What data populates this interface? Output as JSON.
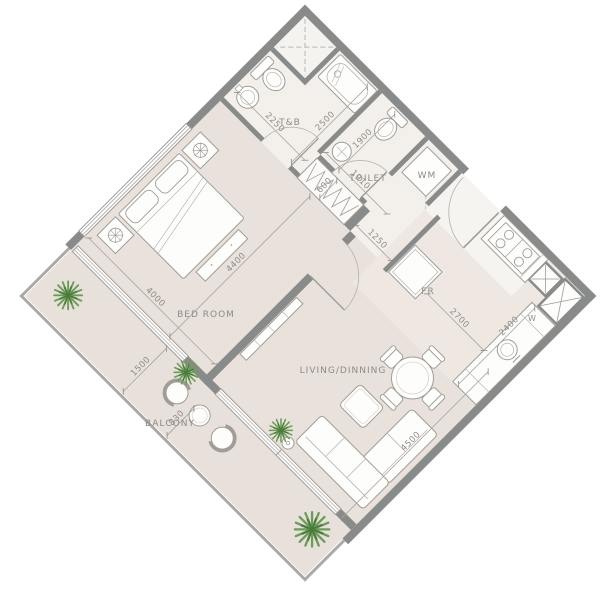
{
  "floor_plan": {
    "rooms": {
      "tnb": "T&B",
      "toilet": "TOILET",
      "washing_machine": "WM",
      "fridge": "FR",
      "bedroom": "BED ROOM",
      "living_dining": "LIVING/DINNING",
      "balcony": "BALCONY",
      "window_mark": "W"
    },
    "dimensions_mm": {
      "tnb_width": "2250",
      "tnb_depth": "2500",
      "toilet_depth": "1900",
      "toilet_width": "1910",
      "closet_depth": "600",
      "hall_width": "1250",
      "bedroom_length": "4400",
      "bedroom_width": "4000",
      "balcony_depth": "1500",
      "balcony_offset": "830",
      "kitchen_clearance": "2700",
      "kitchen_counter": "2400",
      "living_length": "4500"
    },
    "colors": {
      "floor": "#e9e1db",
      "floor_light": "#f3efeb",
      "wall": "#898b8a",
      "railing": "#aaaba9",
      "furniture_line": "#a09c97",
      "plant_green": "#6d9b59"
    }
  }
}
